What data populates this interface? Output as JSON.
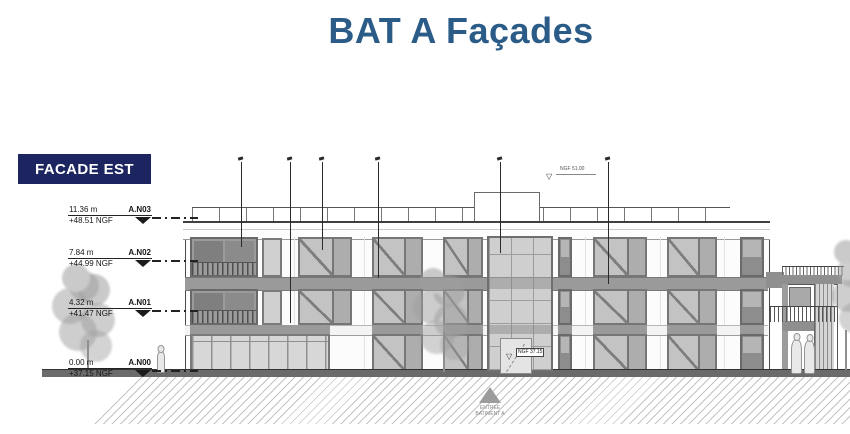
{
  "page": {
    "title": "BAT A Façades",
    "facade_label": "FACADE EST"
  },
  "colors": {
    "title_text": "#2b5c88",
    "facade_label_bg": "#1c2560",
    "facade_label_text": "#ffffff",
    "drawing_line": "#4a4a4a",
    "spandrel_gray": "#9a9a9a"
  },
  "levels": [
    {
      "height": "11.36 m",
      "name": "A.N03",
      "ngf": "+48.51 NGF"
    },
    {
      "height": "7.84 m",
      "name": "A.N02",
      "ngf": "+44.99 NGF"
    },
    {
      "height": "4.32 m",
      "name": "A.N01",
      "ngf": "+41.47 NGF"
    },
    {
      "height": "0.00 m",
      "name": "A.N00",
      "ngf": "+37.15 NGF"
    }
  ],
  "annotations": {
    "roof_level": "NGF 51.00",
    "entrance_level": "NGF 37.15",
    "entrance_title": "ENTREE",
    "entrance_subtitle": "BATIMENT A"
  },
  "icons": {
    "level_marker": "filled-down-triangle",
    "survey_marker": "open-down-triangle",
    "entrance_marker": "filled-up-triangle"
  }
}
